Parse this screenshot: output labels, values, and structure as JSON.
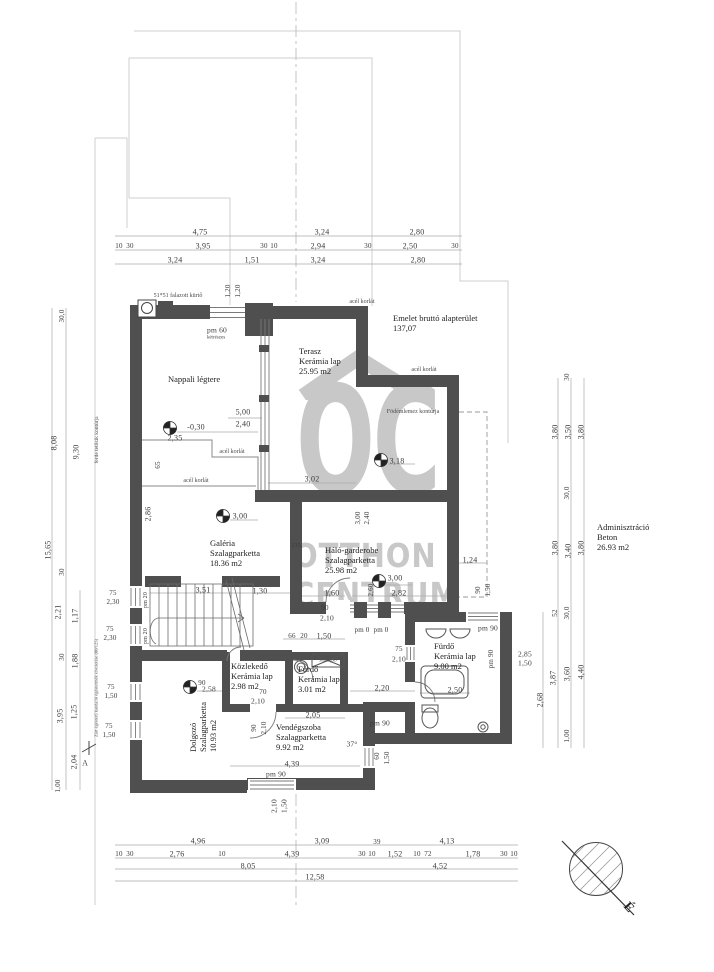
{
  "watermark": {
    "letters": "OC",
    "line1": "OTTHON",
    "line2": "CENTRUM"
  },
  "north": {
    "label": "É"
  },
  "header": {
    "line1": "Emelet bruttó alapterület",
    "line2": "137,07"
  },
  "admin": {
    "name": "Adminisztráció",
    "material": "Beton",
    "area": "26.93 m2"
  },
  "rooms": {
    "nappali": {
      "name": "Nappali légtere"
    },
    "terasz": {
      "name": "Terasz",
      "material": "Kerámia lap",
      "area": "25.95 m2"
    },
    "galeria": {
      "name": "Galéria",
      "material": "Szalagparketta",
      "area": "18.36 m2"
    },
    "halo": {
      "name": "Háló-garderobe",
      "material": "Szalagparketta",
      "area": "25.98 m2"
    },
    "kozlekedo": {
      "name": "Közlekedő",
      "material": "Kerámia lap",
      "area": "2.98 m2"
    },
    "furdo_small": {
      "name": "Fürdő",
      "material": "Kerámia lap",
      "area": "3.01 m2"
    },
    "vendegszoba": {
      "name": "Vendégszoba",
      "material": "Szalagparketta",
      "area": "9.92 m2"
    },
    "dolgozo": {
      "name": "Dolgozó",
      "material": "Szalagparketta",
      "area": "10.93 m2"
    },
    "furdo_big": {
      "name": "Fürdő",
      "material": "Kerámia lap",
      "area": "9.00 m2"
    }
  },
  "colors": {
    "wall": "#4f4f4f",
    "thin_line": "#9a9a9a",
    "watermark": "#c8c8c8",
    "background": "#ffffff"
  },
  "dims": [
    {
      "x": 200,
      "y": 232,
      "t": "4,75"
    },
    {
      "x": 322,
      "y": 232,
      "t": "3,24"
    },
    {
      "x": 417,
      "y": 232,
      "t": "2,80"
    },
    {
      "x": 119,
      "y": 246,
      "t": "10",
      "s": 7
    },
    {
      "x": 130,
      "y": 246,
      "t": "30",
      "s": 7
    },
    {
      "x": 203,
      "y": 246,
      "t": "3,95"
    },
    {
      "x": 264,
      "y": 246,
      "t": "30",
      "s": 7
    },
    {
      "x": 274,
      "y": 246,
      "t": "10",
      "s": 7
    },
    {
      "x": 318,
      "y": 246,
      "t": "2,94"
    },
    {
      "x": 368,
      "y": 246,
      "t": "30",
      "s": 7
    },
    {
      "x": 410,
      "y": 246,
      "t": "2,50"
    },
    {
      "x": 455,
      "y": 246,
      "t": "30",
      "s": 7
    },
    {
      "x": 175,
      "y": 260,
      "t": "3,24"
    },
    {
      "x": 252,
      "y": 260,
      "t": "1,51"
    },
    {
      "x": 318,
      "y": 260,
      "t": "3,24"
    },
    {
      "x": 418,
      "y": 260,
      "t": "2,80"
    },
    {
      "x": 228,
      "y": 291,
      "t": "1,20",
      "r": 1,
      "s": 7
    },
    {
      "x": 238,
      "y": 291,
      "t": "1,20",
      "r": 1,
      "s": 7
    },
    {
      "x": 62,
      "y": 316,
      "t": "30,0",
      "r": 1,
      "s": 7
    },
    {
      "x": 54,
      "y": 443,
      "t": "8,08",
      "r": 1
    },
    {
      "x": 76,
      "y": 452,
      "t": "9,30",
      "r": 1
    },
    {
      "x": 48,
      "y": 550,
      "t": "15,65",
      "r": 1
    },
    {
      "x": 62,
      "y": 572,
      "t": "30",
      "r": 1,
      "s": 7
    },
    {
      "x": 58,
      "y": 612,
      "t": "2,21",
      "r": 1
    },
    {
      "x": 75,
      "y": 616,
      "t": "1,17",
      "r": 1
    },
    {
      "x": 62,
      "y": 657,
      "t": "30",
      "r": 1,
      "s": 7
    },
    {
      "x": 75,
      "y": 661,
      "t": "1,88",
      "r": 1
    },
    {
      "x": 60,
      "y": 716,
      "t": "3,95",
      "r": 1
    },
    {
      "x": 74,
      "y": 712,
      "t": "1,25",
      "r": 1
    },
    {
      "x": 74,
      "y": 762,
      "t": "2,04",
      "r": 1
    },
    {
      "x": 58,
      "y": 786,
      "t": "1,00",
      "r": 1,
      "s": 7
    },
    {
      "x": 113,
      "y": 593,
      "t": "75",
      "s": 7
    },
    {
      "x": 113,
      "y": 602,
      "t": "2,30",
      "s": 7
    },
    {
      "x": 110,
      "y": 629,
      "t": "75",
      "s": 7
    },
    {
      "x": 110,
      "y": 638,
      "t": "2,30",
      "s": 7
    },
    {
      "x": 111,
      "y": 687,
      "t": "75",
      "s": 7
    },
    {
      "x": 111,
      "y": 696,
      "t": "1,50",
      "s": 7
    },
    {
      "x": 109,
      "y": 726,
      "t": "75",
      "s": 7
    },
    {
      "x": 109,
      "y": 735,
      "t": "1,50",
      "s": 7
    },
    {
      "x": 146,
      "y": 600,
      "t": "pm 20",
      "r": 1,
      "s": 6
    },
    {
      "x": 146,
      "y": 636,
      "t": "pm 20",
      "r": 1,
      "s": 6
    },
    {
      "x": 567,
      "y": 377,
      "t": "30",
      "r": 1,
      "s": 7
    },
    {
      "x": 555,
      "y": 432,
      "t": "3,80",
      "r": 1
    },
    {
      "x": 568,
      "y": 432,
      "t": "3,50",
      "r": 1
    },
    {
      "x": 581,
      "y": 432,
      "t": "3,80",
      "r": 1
    },
    {
      "x": 567,
      "y": 493,
      "t": "30,0",
      "r": 1,
      "s": 7
    },
    {
      "x": 555,
      "y": 548,
      "t": "3,80",
      "r": 1
    },
    {
      "x": 568,
      "y": 551,
      "t": "3,40",
      "r": 1
    },
    {
      "x": 581,
      "y": 548,
      "t": "3,80",
      "r": 1
    },
    {
      "x": 555,
      "y": 613,
      "t": "52",
      "r": 1,
      "s": 7
    },
    {
      "x": 567,
      "y": 613,
      "t": "30,0",
      "r": 1,
      "s": 7
    },
    {
      "x": 553,
      "y": 678,
      "t": "3,87",
      "r": 1
    },
    {
      "x": 567,
      "y": 674,
      "t": "3,60",
      "r": 1
    },
    {
      "x": 581,
      "y": 672,
      "t": "4,40",
      "r": 1
    },
    {
      "x": 567,
      "y": 736,
      "t": "1,00",
      "r": 1,
      "s": 7
    },
    {
      "x": 540,
      "y": 700,
      "t": "2,68",
      "r": 1
    },
    {
      "x": 525,
      "y": 654,
      "t": "2,85",
      "s": 7.5
    },
    {
      "x": 525,
      "y": 663,
      "t": "1,50",
      "s": 7.5
    },
    {
      "x": 198,
      "y": 841,
      "t": "4,96"
    },
    {
      "x": 322,
      "y": 841,
      "t": "3,09"
    },
    {
      "x": 377,
      "y": 842,
      "t": "39",
      "s": 7
    },
    {
      "x": 447,
      "y": 841,
      "t": "4,13"
    },
    {
      "x": 119,
      "y": 854,
      "t": "10",
      "s": 7
    },
    {
      "x": 130,
      "y": 854,
      "t": "30",
      "s": 7
    },
    {
      "x": 177,
      "y": 854,
      "t": "2,76"
    },
    {
      "x": 222,
      "y": 854,
      "t": "10",
      "s": 7
    },
    {
      "x": 292,
      "y": 854,
      "t": "4,39"
    },
    {
      "x": 362,
      "y": 854,
      "t": "30",
      "s": 7
    },
    {
      "x": 372,
      "y": 854,
      "t": "10",
      "s": 7
    },
    {
      "x": 395,
      "y": 854,
      "t": "1,52"
    },
    {
      "x": 417,
      "y": 854,
      "t": "10",
      "s": 7
    },
    {
      "x": 428,
      "y": 854,
      "t": "72",
      "s": 7
    },
    {
      "x": 473,
      "y": 854,
      "t": "1,78"
    },
    {
      "x": 504,
      "y": 854,
      "t": "30",
      "s": 7
    },
    {
      "x": 514,
      "y": 854,
      "t": "10",
      "s": 7
    },
    {
      "x": 248,
      "y": 866,
      "t": "8,05"
    },
    {
      "x": 440,
      "y": 866,
      "t": "4,52"
    },
    {
      "x": 315,
      "y": 877,
      "t": "12,58"
    },
    {
      "x": 217,
      "y": 330,
      "t": "pm 60",
      "s": 7.5
    },
    {
      "x": 243,
      "y": 412,
      "t": "5,00"
    },
    {
      "x": 243,
      "y": 424,
      "t": "2,40"
    },
    {
      "x": 196,
      "y": 427,
      "t": "-0,30"
    },
    {
      "x": 175,
      "y": 438,
      "t": "2,35"
    },
    {
      "x": 158,
      "y": 465,
      "t": "65",
      "r": 1,
      "s": 7
    },
    {
      "x": 148,
      "y": 514,
      "t": "2,86",
      "r": 1
    },
    {
      "x": 240,
      "y": 516,
      "t": "3,00"
    },
    {
      "x": 397,
      "y": 461,
      "t": "3,18"
    },
    {
      "x": 312,
      "y": 479,
      "t": "3,02"
    },
    {
      "x": 358,
      "y": 518,
      "t": "3,00",
      "r": 1,
      "s": 7
    },
    {
      "x": 367,
      "y": 518,
      "t": "2,40",
      "r": 1,
      "s": 7
    },
    {
      "x": 203,
      "y": 590,
      "t": "3,51"
    },
    {
      "x": 260,
      "y": 591,
      "t": "1,30"
    },
    {
      "x": 332,
      "y": 593,
      "t": "1,60"
    },
    {
      "x": 399,
      "y": 593,
      "t": "2,82"
    },
    {
      "x": 296,
      "y": 546,
      "t": "135",
      "s": 6
    },
    {
      "x": 325,
      "y": 608,
      "t": "90",
      "s": 7
    },
    {
      "x": 327,
      "y": 618,
      "t": "2,10",
      "s": 7.5
    },
    {
      "x": 395,
      "y": 578,
      "t": "3,00"
    },
    {
      "x": 371,
      "y": 590,
      "t": "2,60",
      "r": 1,
      "s": 7
    },
    {
      "x": 470,
      "y": 560,
      "t": "1,24"
    },
    {
      "x": 478,
      "y": 590,
      "t": "90",
      "r": 1,
      "s": 7
    },
    {
      "x": 488,
      "y": 590,
      "t": "1,50",
      "r": 1,
      "s": 7
    },
    {
      "x": 292,
      "y": 636,
      "t": "66",
      "s": 7
    },
    {
      "x": 304,
      "y": 636,
      "t": "20",
      "s": 7
    },
    {
      "x": 324,
      "y": 636,
      "t": "1,50"
    },
    {
      "x": 362,
      "y": 630,
      "t": "pm 0",
      "s": 7
    },
    {
      "x": 381,
      "y": 630,
      "t": "pm 0",
      "s": 7
    },
    {
      "x": 399,
      "y": 649,
      "t": "75",
      "s": 7
    },
    {
      "x": 399,
      "y": 659,
      "t": "2,10",
      "s": 7.5
    },
    {
      "x": 488,
      "y": 628,
      "t": "pm 90",
      "s": 7.5
    },
    {
      "x": 491,
      "y": 659,
      "t": "pm 90",
      "r": 1,
      "s": 7
    },
    {
      "x": 455,
      "y": 690,
      "t": "2,50"
    },
    {
      "x": 382,
      "y": 688,
      "t": "2,20"
    },
    {
      "x": 202,
      "y": 683,
      "t": "90",
      "s": 7
    },
    {
      "x": 209,
      "y": 689,
      "t": "2,58",
      "s": 7.5
    },
    {
      "x": 263,
      "y": 692,
      "t": "70",
      "s": 7
    },
    {
      "x": 258,
      "y": 701,
      "t": "2,10",
      "s": 7.5
    },
    {
      "x": 254,
      "y": 728,
      "t": "90",
      "r": 1,
      "s": 7
    },
    {
      "x": 264,
      "y": 728,
      "t": "2,10",
      "r": 1,
      "s": 7
    },
    {
      "x": 313,
      "y": 715,
      "t": "2,05"
    },
    {
      "x": 380,
      "y": 723,
      "t": "pm 90",
      "s": 7.5
    },
    {
      "x": 352,
      "y": 744,
      "t": "37°",
      "s": 7.5
    },
    {
      "x": 292,
      "y": 764,
      "t": "4,39"
    },
    {
      "x": 276,
      "y": 774,
      "t": "pm 90",
      "s": 7.5
    },
    {
      "x": 377,
      "y": 756,
      "t": "60",
      "r": 1,
      "s": 7
    },
    {
      "x": 387,
      "y": 758,
      "t": "1,50",
      "r": 1,
      "s": 7
    },
    {
      "x": 274,
      "y": 806,
      "t": "2,10",
      "r": 1,
      "s": 7.5
    },
    {
      "x": 284,
      "y": 806,
      "t": "1,50",
      "r": 1,
      "s": 7.5
    }
  ],
  "notes": [
    {
      "x": 178,
      "y": 296,
      "t": "51*51 falazott kürtő"
    },
    {
      "x": 216,
      "y": 338,
      "t": "kétrészes",
      "s": 5
    },
    {
      "x": 362,
      "y": 302,
      "t": "acél korlát"
    },
    {
      "x": 424,
      "y": 370,
      "t": "acél korlát"
    },
    {
      "x": 232,
      "y": 452,
      "t": "acél korlát"
    },
    {
      "x": 196,
      "y": 481,
      "t": "acél korlát"
    },
    {
      "x": 413,
      "y": 412,
      "t": "Födémlemez kontúrja"
    },
    {
      "x": 97,
      "y": 440,
      "t": "ferde tetősík kontúrja",
      "r": 1,
      "s": 5.5
    },
    {
      "x": 96,
      "y": 688,
      "t": "Zárt égésterű kandalló égéstermék elvezetése (80/125)",
      "r": 1,
      "s": 4.5
    },
    {
      "x": 328,
      "y": 660,
      "t": "zuhanyzó",
      "s": 4.5
    },
    {
      "x": 85,
      "y": 763,
      "t": "A",
      "s": 8
    }
  ]
}
